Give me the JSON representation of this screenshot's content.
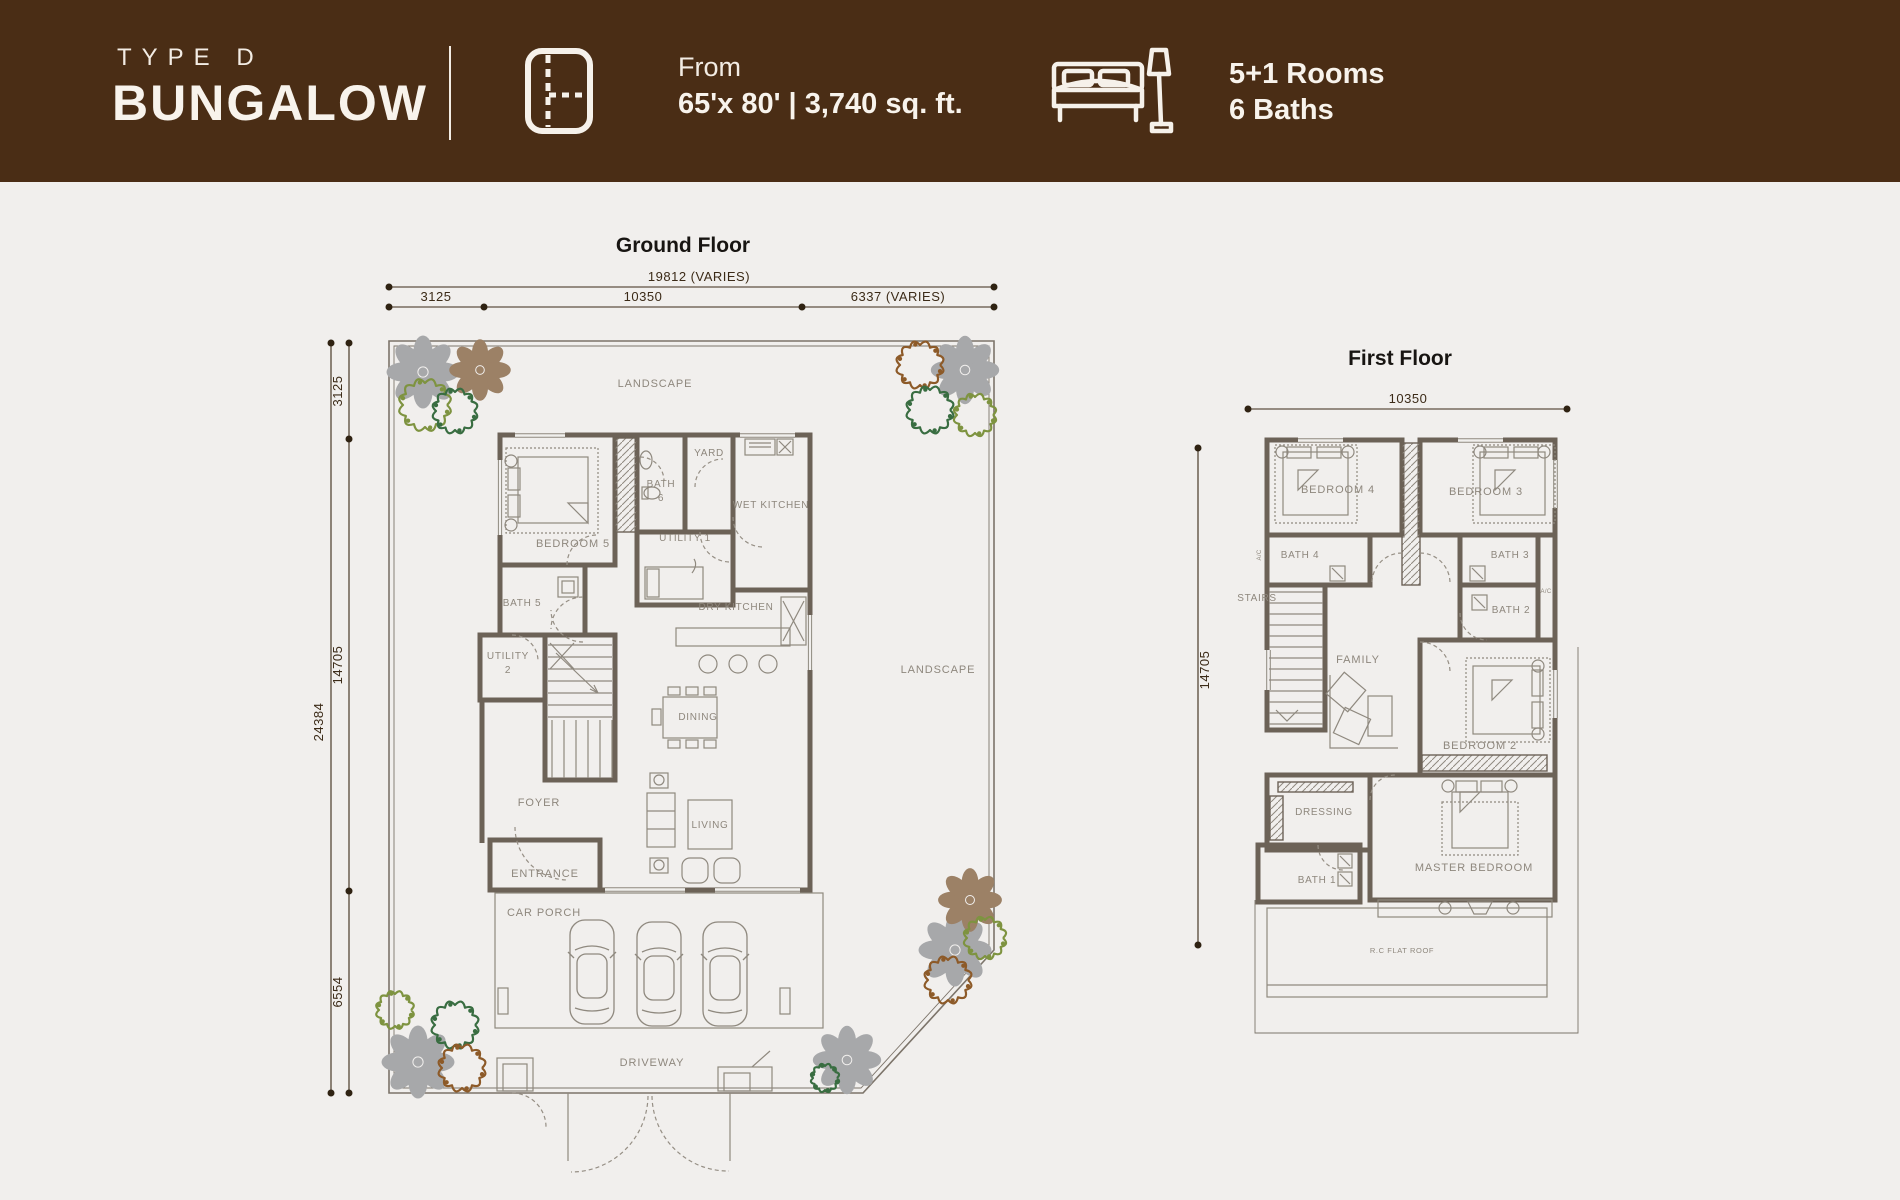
{
  "header": {
    "type_label": "TYPE D",
    "title": "BUNGALOW",
    "from_label": "From",
    "size_text": "65'x 80' | 3,740 sq. ft.",
    "rooms_text": "5+1 Rooms",
    "baths_text": "6 Baths"
  },
  "colors": {
    "header_brown": "#4a2d15",
    "background": "#f1efed",
    "wall": "#6c6257",
    "thin_line": "#8f897f",
    "room_label": "#8e877d",
    "dimension": "#3b2a17",
    "flower_gray": "#a7a8aa",
    "flower_brown": "#9c8166",
    "tree_olive": "#7e9340",
    "tree_dark_green": "#396d41",
    "tree_brown": "#8d5a28"
  },
  "ground_floor": {
    "title": "Ground Floor",
    "dims": {
      "top_total": "19812 (VARIES)",
      "top_seg1": "3125",
      "top_seg2": "10350",
      "top_seg3": "6337 (VARIES)",
      "left_total": "24384",
      "left_seg1": "3125",
      "left_seg2": "14705",
      "left_seg3": "6554"
    },
    "rooms": {
      "landscape_top": "LANDSCAPE",
      "landscape_right": "LANDSCAPE",
      "yard": "YARD",
      "wet_kitchen": "WET KITCHEN",
      "bath6": [
        "BATH",
        "6"
      ],
      "bedroom5": "BEDROOM 5",
      "utility1": "UTILITY 1",
      "bath5": "BATH 5",
      "dry_kitchen": "DRY KITCHEN",
      "utility2": [
        "UTILITY",
        "2"
      ],
      "dining": "DINING",
      "foyer": "FOYER",
      "living": "LIVING",
      "entrance": "ENTRANCE",
      "car_porch": "CAR PORCH",
      "driveway": "DRIVEWAY"
    }
  },
  "first_floor": {
    "title": "First Floor",
    "dims": {
      "top": "10350",
      "left": "14705"
    },
    "rooms": {
      "bedroom4": "BEDROOM 4",
      "bedroom3": "BEDROOM 3",
      "bath4": "BATH 4",
      "bath3": "BATH 3",
      "bath2": "BATH 2",
      "stairs": "STAIRS",
      "family": "FAMILY",
      "bedroom2": "BEDROOM 2",
      "dressing": "DRESSING",
      "master_bedroom": "MASTER BEDROOM",
      "bath1": "BATH 1",
      "rc_flat_roof": "R.C FLAT ROOF",
      "ac_left": "A/C",
      "ac_right": "A/C"
    }
  }
}
